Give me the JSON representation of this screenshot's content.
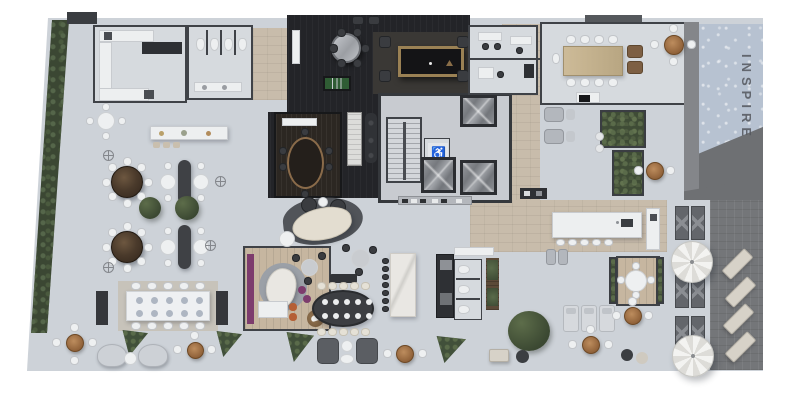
{
  "pool": {
    "label": "INSPIRE",
    "water_color": "#b7c2d1",
    "letter_color": "#54575d",
    "deck_color": "#747679"
  },
  "core": {
    "accessible_icon": "♿"
  },
  "palette": {
    "background": "#ffffff",
    "deck": "#cdd2d8",
    "floor_light": "#d6dade",
    "wall": "#3f4247",
    "dark_room": "#232428",
    "dark_wood_floor": "#2c2722",
    "wood_floor": "#c6b6a0",
    "corridor_tile": "#c8bcab",
    "greenery": "#42503a",
    "accent_purple": "#7d3c6d",
    "umbrella_wood": "#a87c4f",
    "billiard_green": "#2f5c34",
    "elevator_marble": "#8e9196",
    "cream_sofa": "#e3ddd0",
    "orange_chair": "#b55f35"
  }
}
